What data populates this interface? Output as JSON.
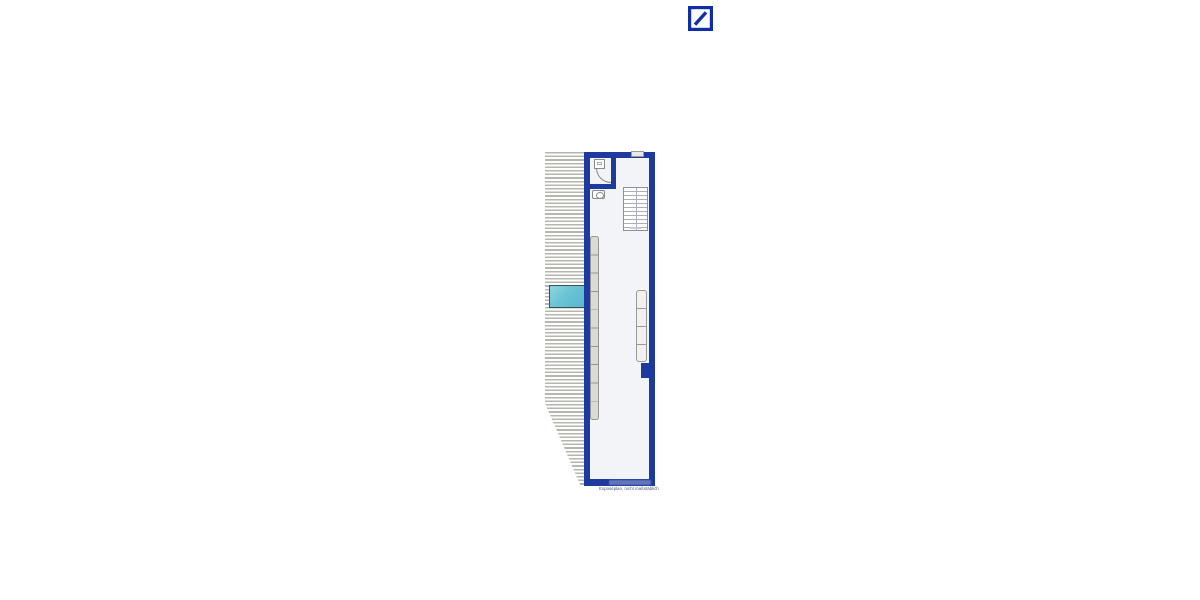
{
  "logo": {
    "name": "deutsche-bank-logo",
    "description": "blue square outline with diagonal slash"
  },
  "colors": {
    "brand-blue": "#0e2fa8",
    "wall-blue": "#1d3a9e",
    "skylight-cyan": "#6ac4d4",
    "interior": "#f3f4f7",
    "hatch-gray": "#b6b6b0",
    "caption-gray": "#44507a"
  },
  "plan": {
    "caption": "Exposéplan, nicht maßstäblich"
  }
}
